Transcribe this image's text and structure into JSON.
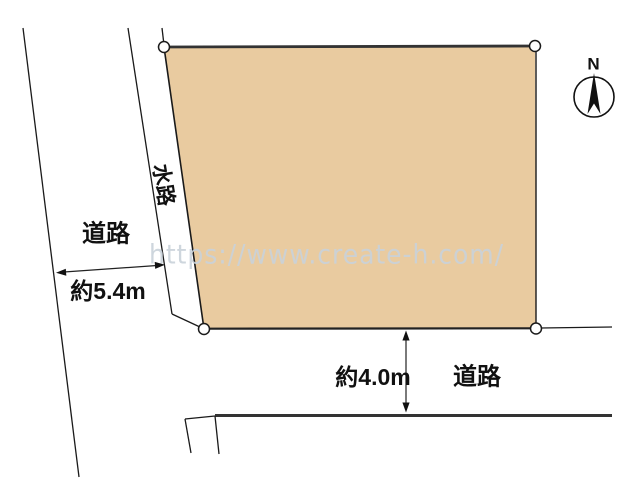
{
  "watermark": {
    "text": "https://www.create-h.com/",
    "color": "#c9d2da"
  },
  "compass": {
    "north_label": "N"
  },
  "parcel": {
    "fill_color": "#e9cba0",
    "outline_color": "#1a1a1a",
    "corner_marker_count": 4
  },
  "waterway": {
    "label": "水路"
  },
  "roads": {
    "left": {
      "label": "道路",
      "width_label": "約5.4m"
    },
    "bottom": {
      "label": "道路",
      "width_label": "約4.0m"
    }
  }
}
